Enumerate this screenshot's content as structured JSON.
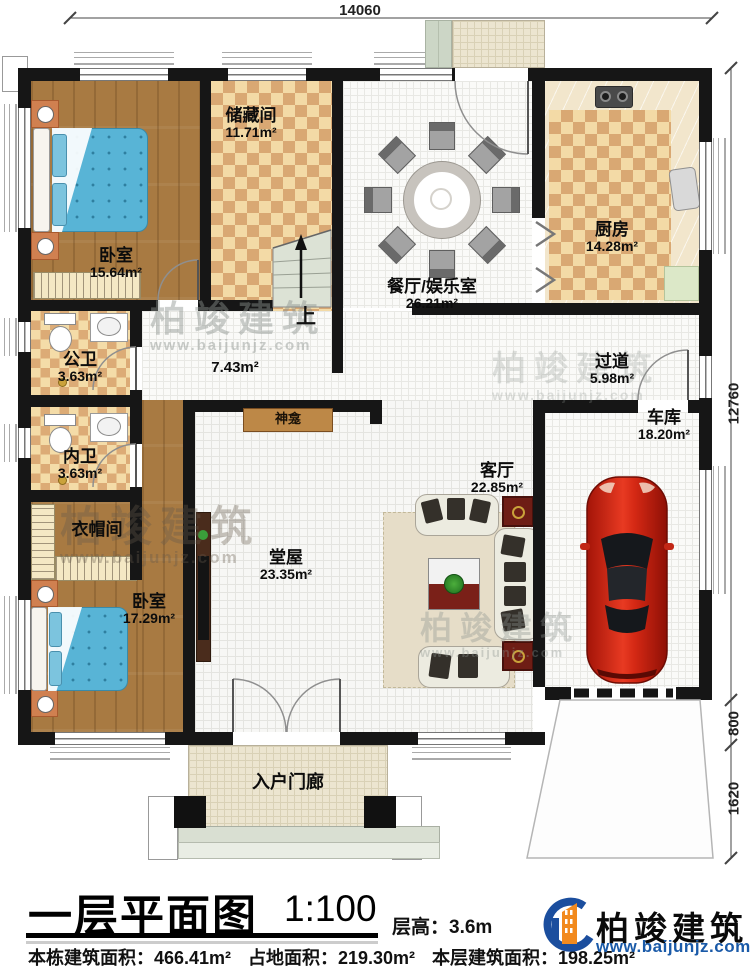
{
  "plan": {
    "rooms": {
      "bedroom_top": {
        "name": "卧室",
        "area": "15.64m²"
      },
      "storage": {
        "name": "储藏间",
        "area": "11.71m²"
      },
      "dining": {
        "name": "餐厅/娱乐室",
        "area": "26.21m²"
      },
      "kitchen": {
        "name": "厨房",
        "area": "14.28m²"
      },
      "public_bath": {
        "name": "公卫",
        "area": "3.63m²"
      },
      "inner_bath": {
        "name": "内卫",
        "area": "3.63m²"
      },
      "cloakroom": {
        "name": "衣帽间"
      },
      "mid_hall": {
        "area": "7.43m²"
      },
      "corridor": {
        "name": "过道",
        "area": "5.98m²"
      },
      "main_hall": {
        "name": "堂屋",
        "area": "23.35m²"
      },
      "living_room": {
        "name": "客厅",
        "area": "22.85m²"
      },
      "garage": {
        "name": "车库",
        "area": "18.20m²"
      },
      "bedroom_bottom": {
        "name": "卧室",
        "area": "17.29m²"
      },
      "entry_porch": {
        "name": "入户门廊"
      },
      "shrine": {
        "name": "神龛"
      },
      "stairs": {
        "direction": "上"
      }
    },
    "dimensions": {
      "top_width": "14060",
      "right_main": "12760",
      "right_mid": "800",
      "right_bottom": "1620"
    }
  },
  "title_block": {
    "title": "一层平面图",
    "scale": "1:100",
    "floor_height": "层高：3.6m",
    "building_total_area": "本栋建筑面积：466.41m²",
    "land_area": "占地面积：219.30m²",
    "floor_area": "本层建筑面积：198.25m²"
  },
  "brand": {
    "name": "柏竣建筑",
    "website": "www.baijunjz.com"
  },
  "colors": {
    "wall": "#161616",
    "wood": "#a87a42",
    "checker_dark": "#d9a873",
    "checker_light": "#f3daa6",
    "car_red": "#c81e10",
    "brand_blue": "#1b4e9e",
    "brand_orange": "#f28a1e"
  }
}
